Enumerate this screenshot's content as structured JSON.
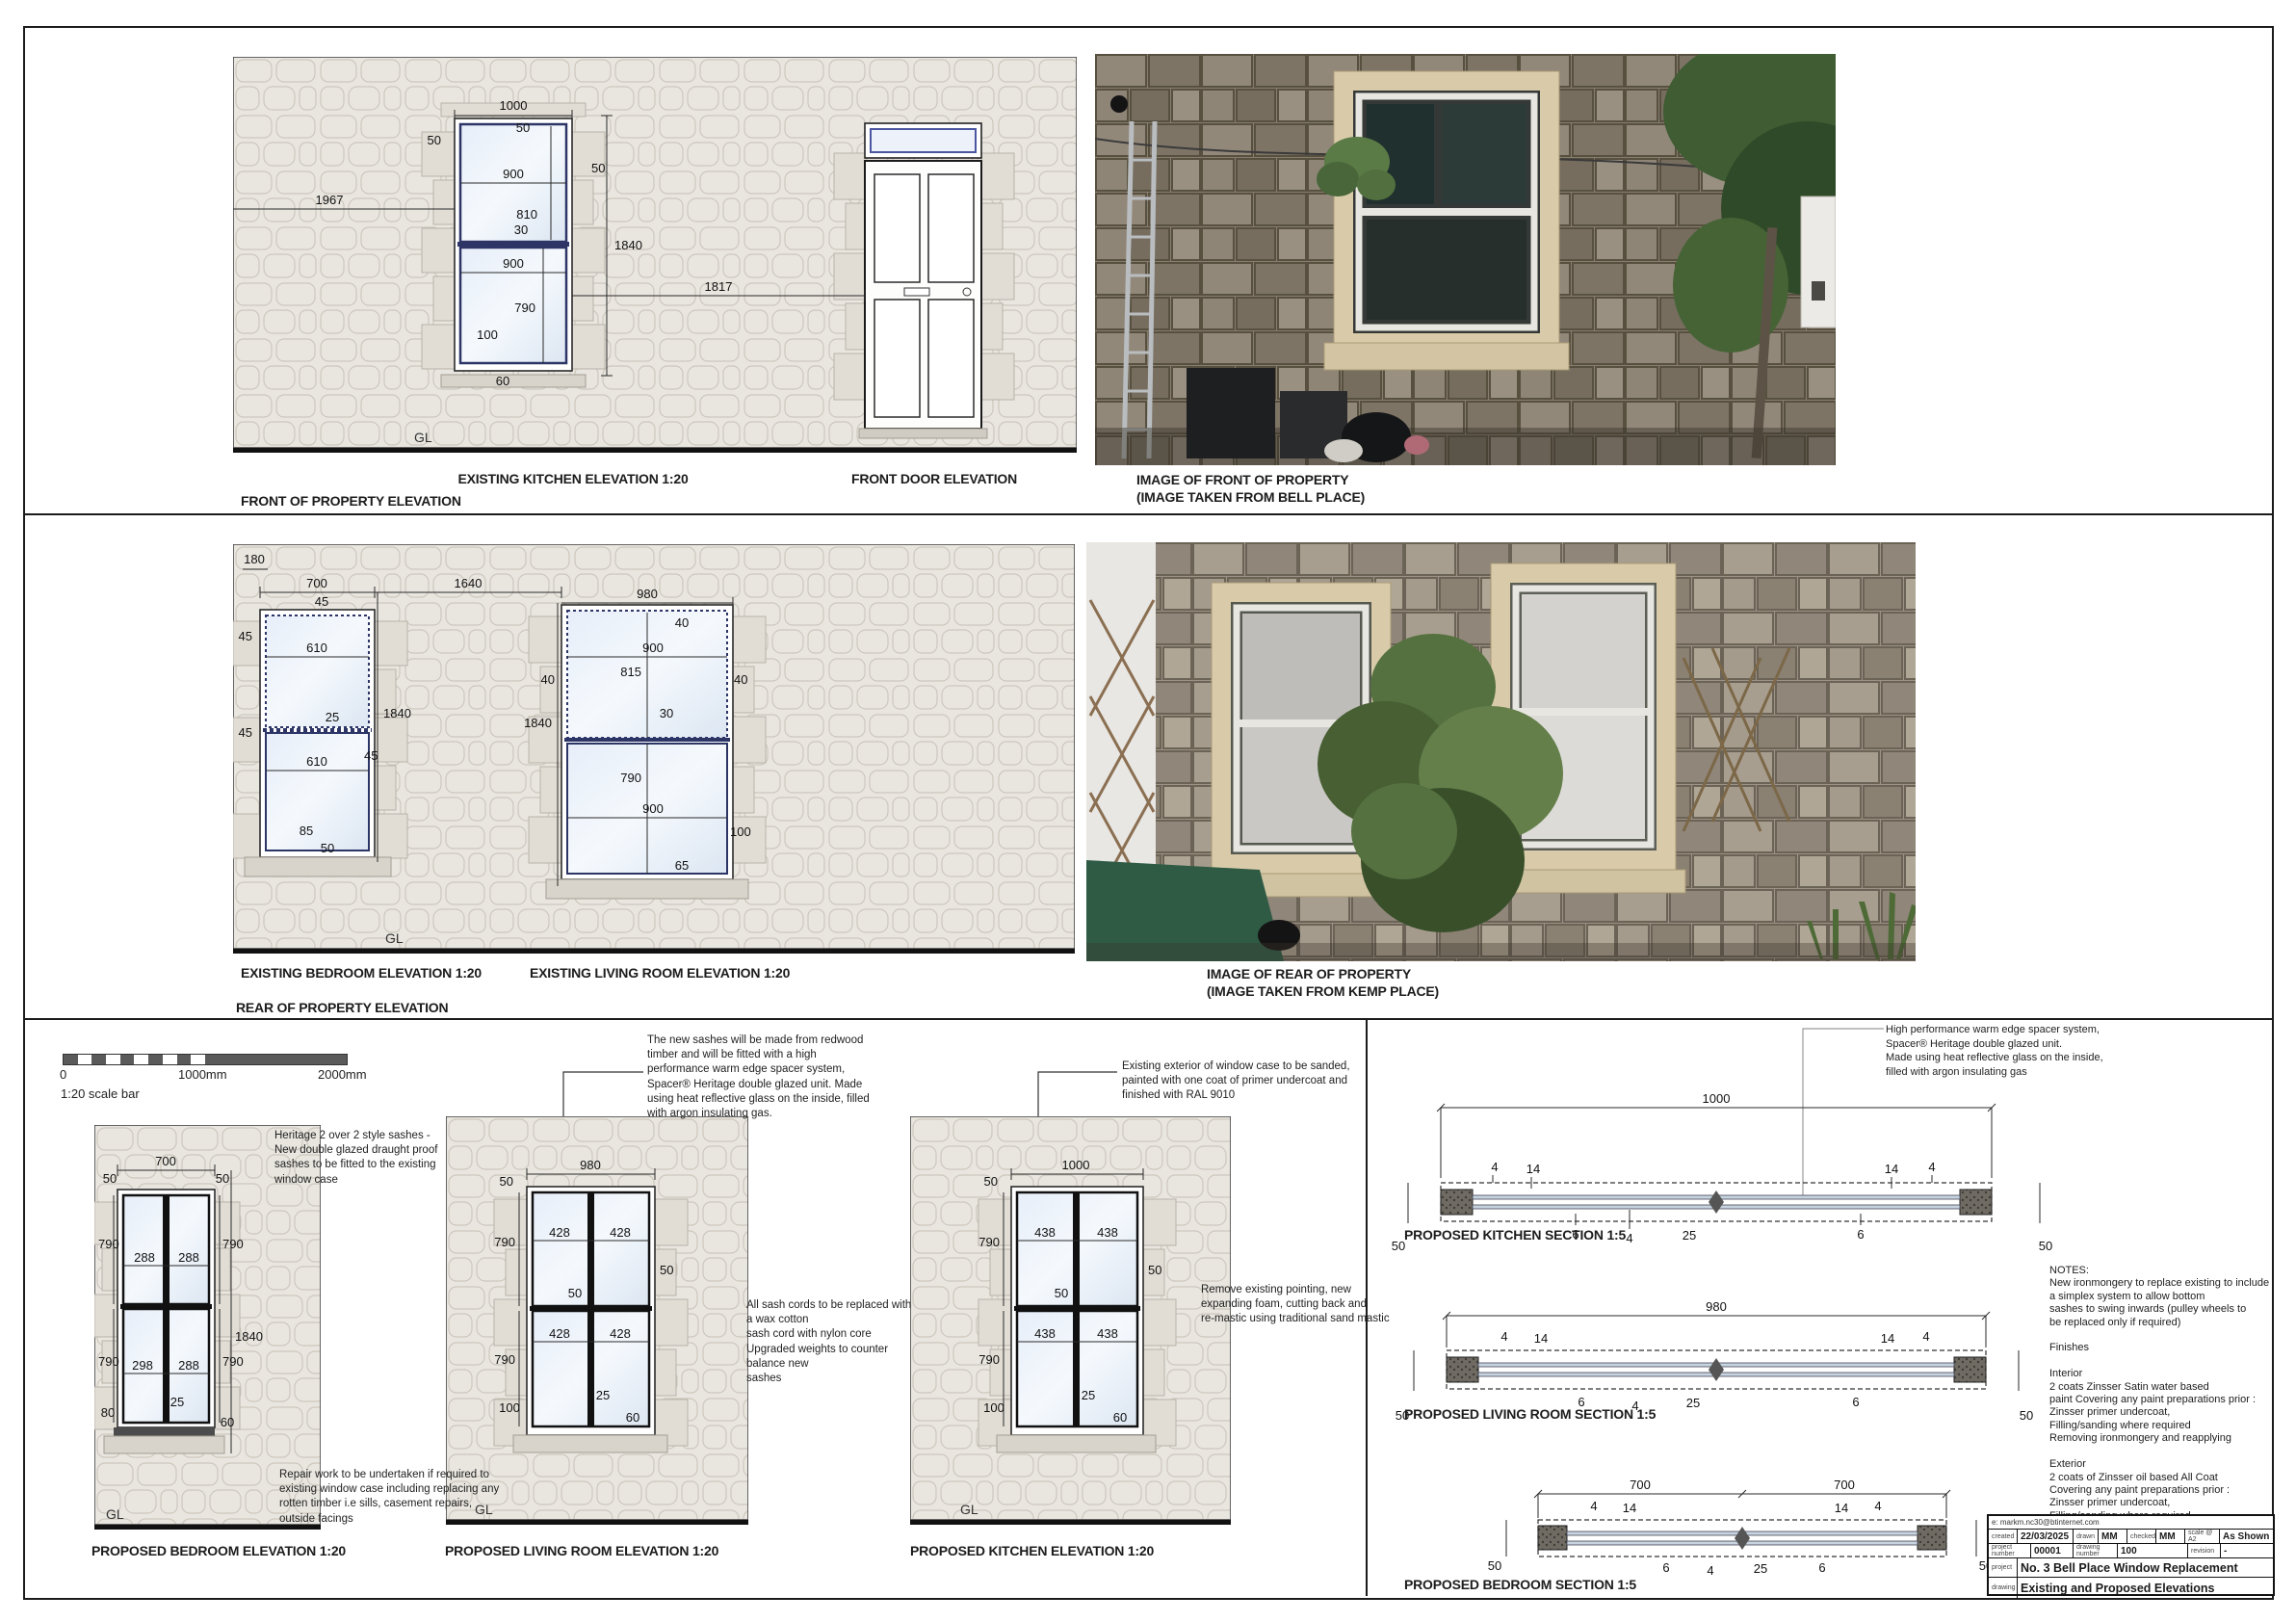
{
  "sheet": {
    "front": {
      "label": "FRONT OF PROPERTY ELEVATION",
      "gl": "GL",
      "kitchen": {
        "caption": "EXISTING KITCHEN ELEVATION 1:20",
        "dims": {
          "width": "1000",
          "head": "50",
          "jamb_l": "50",
          "top_w": "900",
          "top_h": "810",
          "jamb_r": "50",
          "total": "1840",
          "offset": "1967",
          "meeting": "30",
          "bot_w": "900",
          "bot_h": "790",
          "bottom": "100",
          "sill": "60",
          "door_gap": "1817"
        }
      },
      "door": {
        "caption": "FRONT DOOR ELEVATION"
      },
      "photo": {
        "line1": "IMAGE OF FRONT OF PROPERTY",
        "line2": "(IMAGE TAKEN FROM BELL PLACE)"
      }
    },
    "rear": {
      "label": "REAR OF PROPERTY ELEVATION",
      "gl": "GL",
      "bedroom": {
        "caption": "EXISTING BEDROOM ELEVATION 1:20",
        "dims": {
          "offset": "180",
          "width": "700",
          "head": "45",
          "jamb_tl": "45",
          "top_w": "610",
          "meeting": "25",
          "jamb_bl": "45",
          "jamb_r": "45",
          "bot_w": "610",
          "total": "1840",
          "bottom": "85",
          "sill": "50",
          "gap": "1640"
        }
      },
      "living": {
        "caption": "EXISTING LIVING ROOM ELEVATION 1:20",
        "dims": {
          "width": "980",
          "corner": "40",
          "top_w": "900",
          "top_h": "815",
          "jamb_l": "40",
          "jamb_r": "40",
          "meeting": "30",
          "total": "1840",
          "bot_h": "790",
          "bot_w": "900",
          "bottom": "100",
          "sill": "65"
        }
      },
      "photo": {
        "line1": "IMAGE OF REAR OF PROPERTY",
        "line2": "(IMAGE TAKEN FROM KEMP PLACE)"
      }
    },
    "proposed": {
      "gl": "GL",
      "scale_bar": {
        "zero": "0",
        "mid": "1000mm",
        "end": "2000mm",
        "label": "1:20 scale bar"
      },
      "bedroom": {
        "caption": "PROPOSED BEDROOM ELEVATION 1:20",
        "note_top": "Heritage 2 over 2 style sashes -\nNew double glazed draught proof\nsashes to be fitted to the existing\nwindow case",
        "note_bottom": "Repair work to be undertaken if required to\nexisting window case including replacing any\nrotten timber i.e sills, casement repairs,\noutside facings",
        "dims": {
          "width": "700",
          "head_l": "50",
          "head_r": "50",
          "top_hl": "790",
          "pane_tl": "288",
          "pane_tr": "288",
          "top_hr": "790",
          "total": "1840",
          "pane_bl": "298",
          "pane_br": "288",
          "bot_hl": "790",
          "bot_hr": "790",
          "meeting": "25",
          "bottom": "80",
          "sill": "60"
        }
      },
      "living": {
        "caption": "PROPOSED LIVING ROOM ELEVATION 1:20",
        "note_top": "The new sashes will be made from redwood\ntimber and will be fitted with a high\nperformance warm edge spacer system,\nSpacer® Heritage double glazed unit. Made\nusing heat reflective glass on the inside, filled\nwith argon insulating gas.",
        "note_right": "All sash cords to be replaced with\na wax cotton\nsash cord with nylon core\nUpgraded weights to counter\nbalance new\nsashes",
        "dims": {
          "width": "980",
          "head": "50",
          "top_h": "790",
          "pane_tl": "428",
          "pane_tr": "428",
          "jamb_r": "50",
          "meeting": "50",
          "pane_bl": "428",
          "pane_br": "428",
          "bot_h": "790",
          "bottom": "100",
          "rail": "25",
          "sill": "60"
        }
      },
      "kitchen": {
        "caption": "PROPOSED KITCHEN ELEVATION 1:20",
        "note_top": "Existing exterior of window case to be sanded,\npainted with one coat of primer undercoat and\nfinished with RAL 9010",
        "note_right": "Remove existing pointing, new\nexpanding foam, cutting back and\nre-mastic using traditional sand mastic",
        "dims": {
          "width": "1000",
          "head": "50",
          "top_h": "790",
          "pane_tl": "438",
          "pane_tr": "438",
          "jamb_r": "50",
          "meeting": "50",
          "pane_bl": "438",
          "pane_br": "438",
          "bot_h": "790",
          "bottom": "100",
          "rail": "25",
          "sill": "60"
        }
      }
    },
    "sections": {
      "note_top": "High performance warm edge spacer system,\nSpacer® Heritage double glazed unit.\nMade using heat reflective glass on the inside,\nfilled with argon insulating gas",
      "kitchen": {
        "caption": "PROPOSED KITCHEN SECTION 1:5",
        "dims": {
          "width": "1000",
          "a4": "4",
          "a14": "14",
          "a6": "6",
          "b4": "4",
          "c25": "25",
          "b14": "14",
          "c4": "4",
          "d6": "6",
          "side_l": "50",
          "side_r": "50"
        }
      },
      "living": {
        "caption": "PROPOSED LIVING ROOM SECTION 1:5",
        "dims": {
          "width": "980",
          "a4": "4",
          "a14": "14",
          "a6": "6",
          "b4": "4",
          "c25": "25",
          "b14": "14",
          "c4": "4",
          "d6": "6",
          "side_l": "50",
          "side_r": "50"
        }
      },
      "bedroom": {
        "caption": "PROPOSED BEDROOM SECTION 1:5",
        "dims": {
          "width_a": "700",
          "width_b": "700",
          "a4": "4",
          "a14": "14",
          "a6": "6",
          "b4": "4",
          "c25": "25",
          "b14": "14",
          "c4": "4",
          "d6": "6",
          "side_l": "50",
          "side_r": "50"
        }
      },
      "notes": "NOTES:\nNew ironmongery to replace existing to include\na simplex system to allow bottom\nsashes to swing inwards (pulley wheels to\nbe replaced only if required)\n\nFinishes\n\nInterior\n2 coats Zinsser Satin water based\npaint Covering any paint preparations prior :\nZinsser primer undercoat,\nFilling/sanding where required\nRemoving ironmongery and reapplying\n\nExterior\n2 coats of Zinsser oil based All Coat\nCovering any paint preparations prior :\nZinsser primer undercoat,\nFilling/sanding where required"
    },
    "title_block": {
      "email": "e: markm.nc30@btinternet.com",
      "created_label": "created",
      "created": "22/03/2025",
      "drawn_label": "drawn",
      "drawn": "MM",
      "checked_label": "checked",
      "checked": "MM",
      "scale_label": "scale @ A2",
      "scale": "As Shown",
      "project_number_label": "project number",
      "project_number": "00001",
      "drawing_number_label": "drawing number",
      "drawing_number": "100",
      "revision_label": "revision",
      "revision": "-",
      "project_label": "project",
      "project": "No. 3 Bell Place Window Replacement",
      "drawing_label": "drawing",
      "drawing": "Existing and Proposed Elevations"
    }
  }
}
